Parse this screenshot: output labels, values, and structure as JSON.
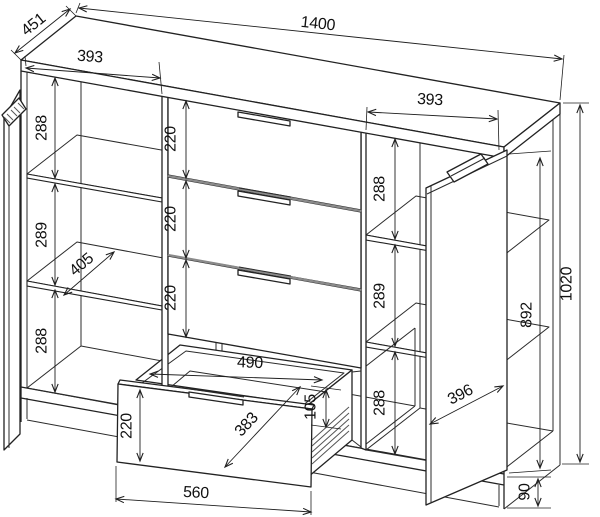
{
  "style": {
    "background": "#ffffff",
    "line_color": "#222222",
    "separator_color": "#8a8a8a",
    "label_color": "#111111"
  },
  "dimensions": {
    "overall_width": "1400",
    "overall_depth": "451",
    "overall_height": "1020",
    "left_section_width": "393",
    "right_section_width": "393",
    "left_opening_top_height": "288",
    "left_opening_middle_height": "289",
    "left_opening_bottom_height": "288",
    "shelf_depth": "405",
    "drawer_front_height_1": "220",
    "drawer_front_height_2": "220",
    "drawer_front_height_3": "220",
    "right_opening_top_height": "288",
    "right_opening_middle_height": "289",
    "right_opening_bottom_height": "288",
    "interior_height": "892",
    "door_width": "396",
    "plinth_height": "90",
    "open_drawer_inner_width": "490",
    "open_drawer_inner_depth": "383",
    "open_drawer_inner_height": "105",
    "open_drawer_front_height": "220",
    "open_drawer_front_width": "560"
  }
}
